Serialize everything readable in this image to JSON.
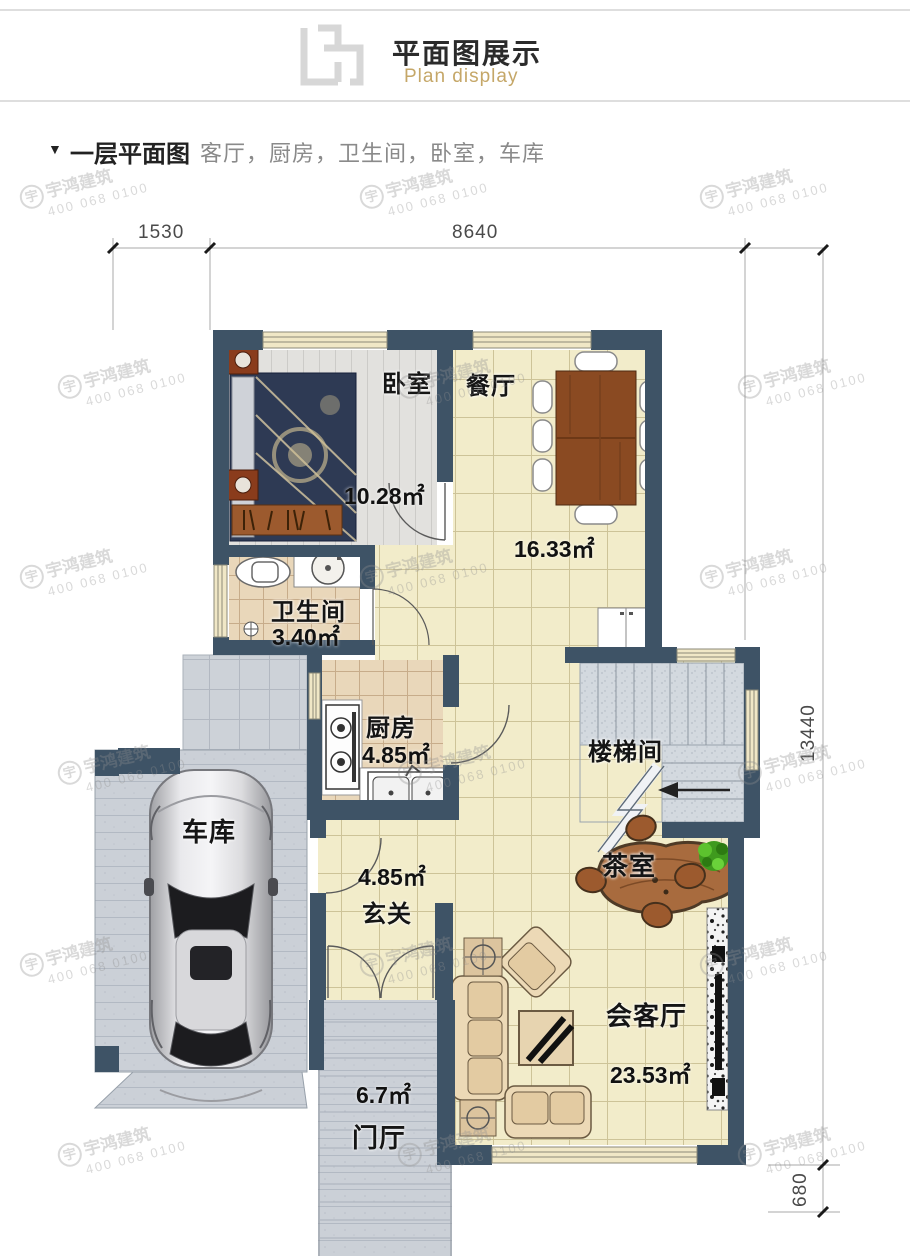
{
  "header": {
    "title": "平面图展示",
    "subtitle": "Plan display"
  },
  "section": {
    "marker": "▼",
    "title": "一层平面图",
    "room_list": "客厅，厨房，卫生间，卧室，车库"
  },
  "dimensions": {
    "top_left": "1530",
    "top_width": "8640",
    "right_height": "13440",
    "bottom_offset": "680"
  },
  "rooms": {
    "bedroom": {
      "name": "卧室",
      "area": "10.28㎡"
    },
    "dining": {
      "name": "餐厅",
      "area": "16.33㎡"
    },
    "bathroom": {
      "name": "卫生间",
      "area": "3.40㎡"
    },
    "kitchen": {
      "name": "厨房",
      "area": "4.85㎡"
    },
    "stairwell": {
      "name": "楼梯间"
    },
    "garage": {
      "name": "车库"
    },
    "entry": {
      "name": "玄关",
      "area": "4.85㎡"
    },
    "tearoom": {
      "name": "茶室"
    },
    "living": {
      "name": "会客厅",
      "area": "23.53㎡"
    },
    "foyer": {
      "name": "门厅",
      "area": "6.7㎡"
    }
  },
  "watermark": {
    "logo": "宇",
    "brand": "宇鸿建筑",
    "phone": "400 068 0100"
  },
  "colors": {
    "wall": "#3e5366",
    "gold": "#c5a768",
    "floor_cream": "#f2ecca"
  }
}
